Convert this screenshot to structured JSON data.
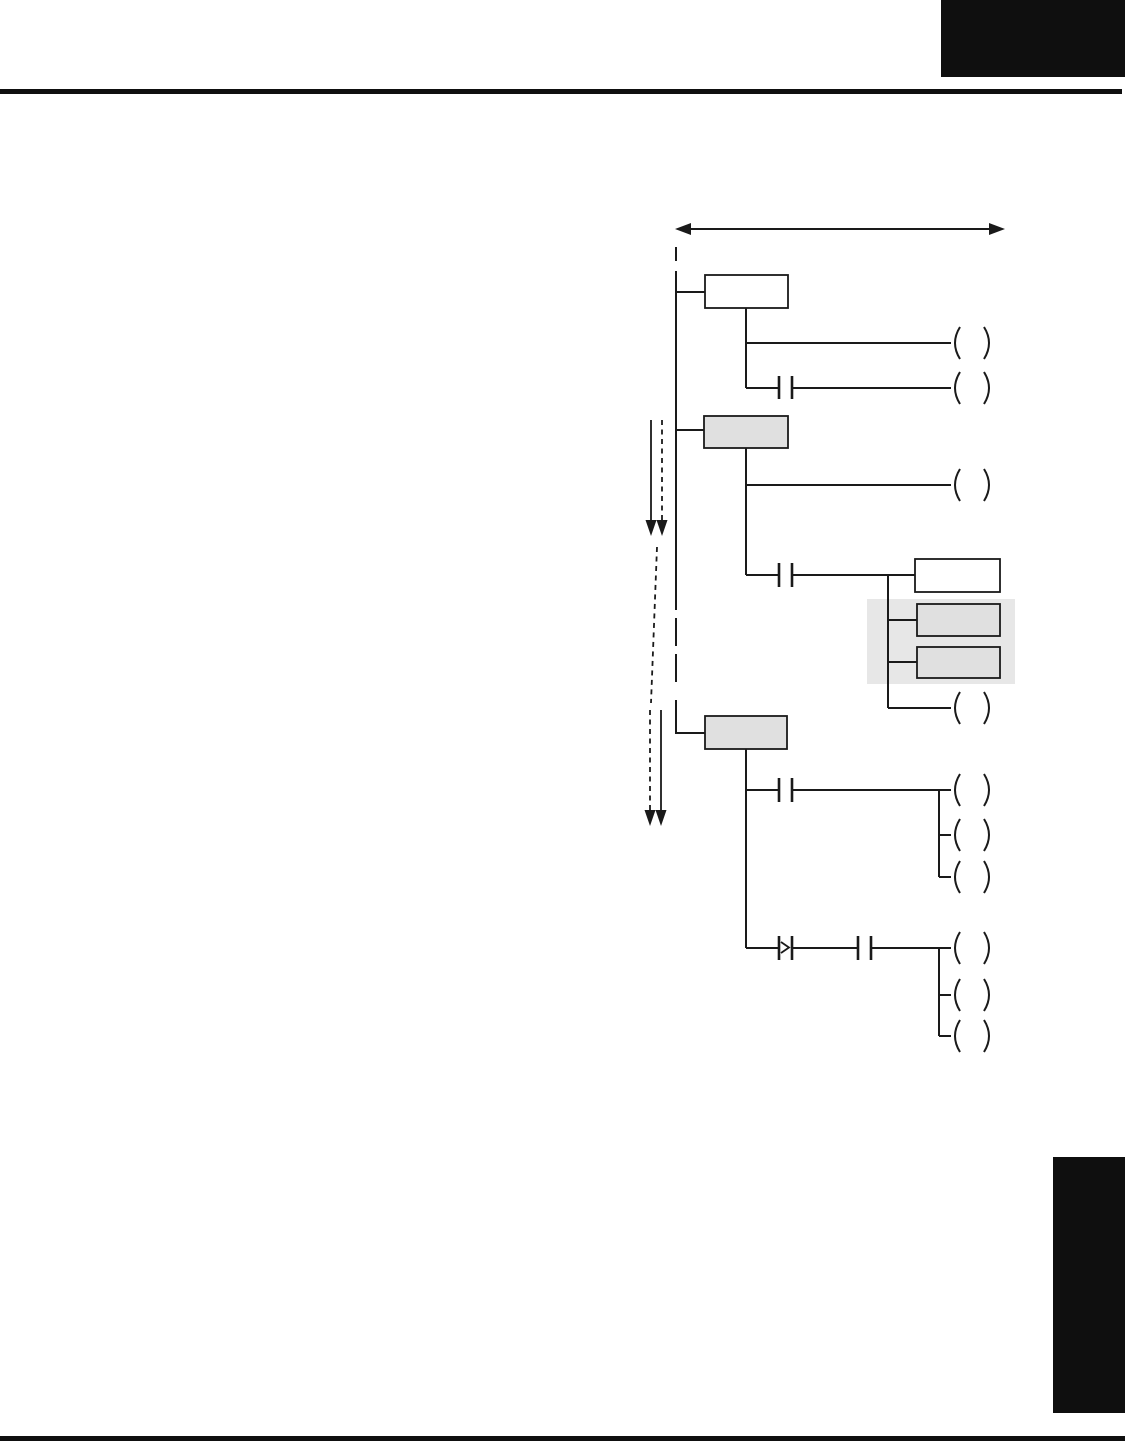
{
  "colors": {
    "paper": "#ffffff",
    "ink": "#1a1a1a",
    "block": "#0f0f0f",
    "box-fill": "#e0e0e0",
    "highlight": "#e7e7e7"
  },
  "page": {
    "kind": "manual-page",
    "header": {
      "corner_block": "chapter-number-block",
      "rule": "header-rule"
    },
    "footer": {
      "rule": "footer-rule"
    },
    "side_tab": "chapter-edge-tab"
  },
  "diagram": {
    "type": "ladder-stage-program",
    "scan_range_arrow": {
      "shape": "horizontal-double-headed-arrow"
    },
    "execution_flow_arrows": {
      "pairs": 2,
      "styles": [
        "solid",
        "dashed"
      ],
      "direction": "down"
    },
    "power_rail": {
      "style": "vertical, partially dashed"
    },
    "stages": [
      {
        "id": 1,
        "box_fill": "white",
        "rungs": [
          {
            "inputs": [],
            "coils": 1
          },
          {
            "inputs": [
              "contact"
            ],
            "coils": 1
          }
        ]
      },
      {
        "id": 2,
        "box_fill": "gray",
        "rungs": [
          {
            "inputs": [],
            "coils": 1
          },
          {
            "inputs": [
              "contact"
            ],
            "function_box": "white",
            "highlighted_boxes": 2,
            "coils": 1
          }
        ]
      },
      {
        "id": 3,
        "box_fill": "gray",
        "rungs": [
          {
            "inputs": [
              "contact"
            ],
            "coils": 3
          },
          {
            "inputs": [
              "compare-contact",
              "contact"
            ],
            "coils": 3
          }
        ]
      }
    ]
  }
}
